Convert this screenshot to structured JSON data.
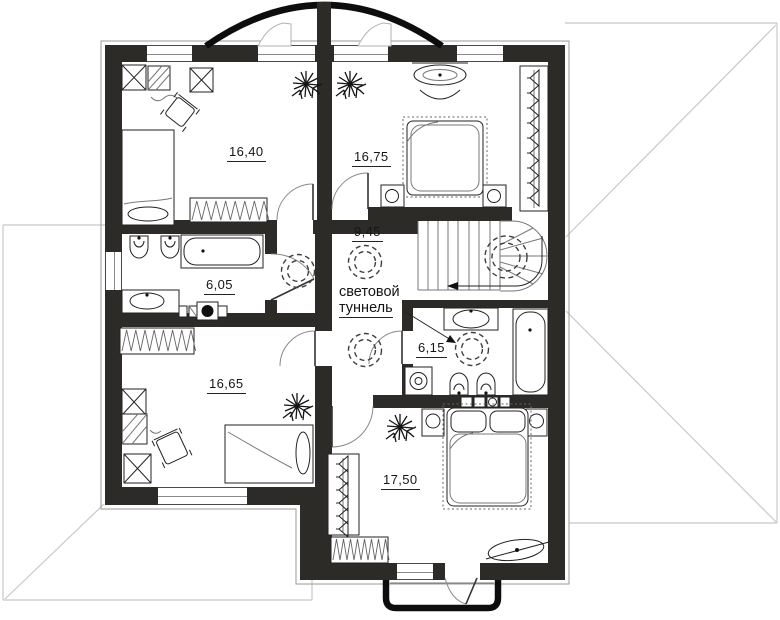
{
  "plan": {
    "rooms": {
      "bedroom_top_left": {
        "area": "16,40"
      },
      "bedroom_top_right": {
        "area": "16,75"
      },
      "hall": {
        "area": "9,45"
      },
      "bathroom_left": {
        "area": "6,05"
      },
      "bathroom_right": {
        "area": "6,15"
      },
      "bedroom_bottom_left": {
        "area": "16,65"
      },
      "bedroom_bottom_right": {
        "area": "17,50"
      }
    },
    "annotations": {
      "light_tunnel_line1": "световой",
      "light_tunnel_line2": "туннель"
    },
    "colors": {
      "wall": "#2d2b28",
      "roof_line": "#c8c8c8",
      "drawing_line": "#1a1a1a",
      "label_text": "#151515"
    },
    "icons": {
      "light_tunnel": "dashed-double-circle",
      "staircase": "u-turn-stairs-with-walk-arrow",
      "door": "quarter-arc-swing",
      "radiator": "zigzag-coil",
      "wardrobe": "crossed-box",
      "closet": "hanger-row",
      "plant": "leaf-burst"
    }
  }
}
